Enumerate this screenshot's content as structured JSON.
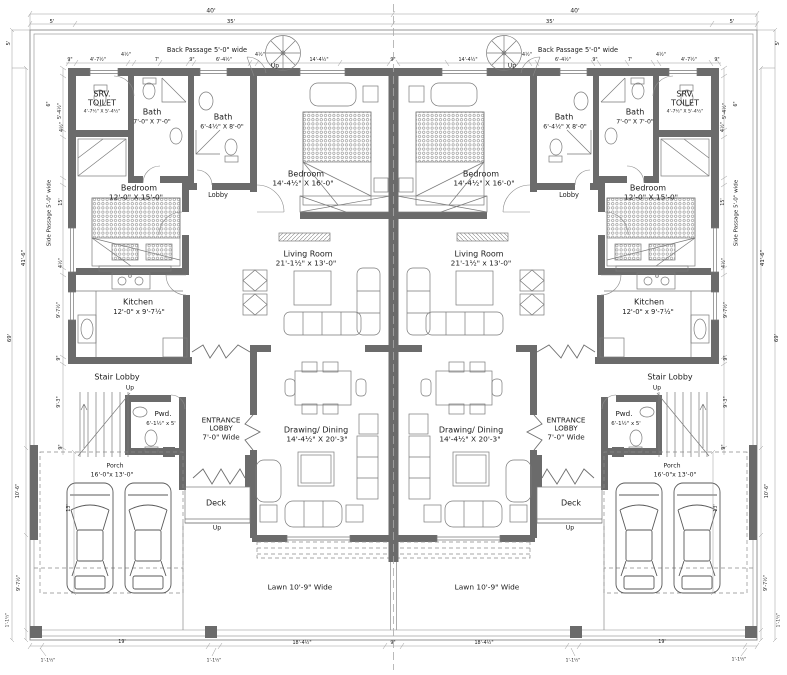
{
  "colors": {
    "wall": "#6b6b6b",
    "line": "#7a7a7a",
    "dim_line": "#9a9a9a",
    "text": "#1b1b1b"
  },
  "site": {
    "back_passage": "Back Passage 5'-0\" wide",
    "side_passage": "Side Passage 5'-0\" wide",
    "lawn": "Lawn 10'-9\" Wide"
  },
  "labels": [
    {
      "id": "room-srv-toilet-left-name",
      "t": "SRV.\nTOILET",
      "x": 102,
      "y": 99,
      "fs": 8
    },
    {
      "id": "room-srv-toilet-left-size",
      "t": "4'-7½\" X 5'-4½\"",
      "x": 102,
      "y": 112,
      "fs": 4.6
    },
    {
      "id": "room-bath1-left-name",
      "t": "Bath",
      "x": 152,
      "y": 112,
      "fs": 8
    },
    {
      "id": "room-bath1-left-size",
      "t": "7'-0\" X 7'-0\"",
      "x": 152,
      "y": 122,
      "fs": 6.2
    },
    {
      "id": "room-bath2-left-name",
      "t": "Bath",
      "x": 223,
      "y": 117,
      "fs": 8
    },
    {
      "id": "room-bath2-left-size",
      "t": "6'-4½\" X 8'-0\"",
      "x": 222,
      "y": 127,
      "fs": 6.2
    },
    {
      "id": "room-bedroom-center-left-name",
      "t": "Bedroom",
      "x": 306,
      "y": 174,
      "fs": 8
    },
    {
      "id": "room-bedroom-center-left-size",
      "t": "14'-4½\" X 16'-0\"",
      "x": 303,
      "y": 184,
      "fs": 7.4
    },
    {
      "id": "room-lobby-left",
      "t": "Lobby",
      "x": 218,
      "y": 196,
      "fs": 6.6
    },
    {
      "id": "room-bedroom-side-left-name",
      "t": "Bedroom",
      "x": 139,
      "y": 188,
      "fs": 8
    },
    {
      "id": "room-bedroom-side-left-size",
      "t": "12'-0\" X 15'-0\"",
      "x": 136,
      "y": 198,
      "fs": 7.4
    },
    {
      "id": "room-living-left-name",
      "t": "Living Room",
      "x": 308,
      "y": 254,
      "fs": 8
    },
    {
      "id": "room-living-left-size",
      "t": "21'-1½\" x 13'-0\"",
      "x": 306,
      "y": 264,
      "fs": 7.4
    },
    {
      "id": "room-kitchen-left-name",
      "t": "Kitchen",
      "x": 138,
      "y": 302,
      "fs": 8
    },
    {
      "id": "room-kitchen-left-size",
      "t": "12'-0\" x 9'-7½\"",
      "x": 139,
      "y": 312,
      "fs": 6.8
    },
    {
      "id": "room-stair-lobby-left",
      "t": "Stair Lobby",
      "x": 117,
      "y": 377,
      "fs": 8
    },
    {
      "id": "label-up-stair-left",
      "t": "Up",
      "x": 130,
      "y": 388,
      "fs": 6
    },
    {
      "id": "room-pwd-left-name",
      "t": "Pwd.",
      "x": 163,
      "y": 414,
      "fs": 7.2
    },
    {
      "id": "room-pwd-left-size",
      "t": "6'-1½\" x 5'",
      "x": 161,
      "y": 424,
      "fs": 5.4
    },
    {
      "id": "room-entrance-lobby-left",
      "t": "ENTRANCE\nLOBBY\n7'-0\" Wide",
      "x": 221,
      "y": 429,
      "fs": 7.2
    },
    {
      "id": "room-drawing-dining-left-name",
      "t": "Drawing/ Dining",
      "x": 316,
      "y": 430,
      "fs": 8
    },
    {
      "id": "room-drawing-dining-left-size",
      "t": "14'-4½\" X 20'-3\"",
      "x": 317,
      "y": 440,
      "fs": 7.4
    },
    {
      "id": "room-deck-left",
      "t": "Deck",
      "x": 216,
      "y": 503,
      "fs": 8
    },
    {
      "id": "label-up-deck-left",
      "t": "Up",
      "x": 217,
      "y": 528,
      "fs": 6.2
    },
    {
      "id": "room-porch-left-name",
      "t": "Porch",
      "x": 115,
      "y": 466,
      "fs": 6.2
    },
    {
      "id": "room-porch-left-size",
      "t": "16'-0\"x 13'-0\"",
      "x": 112,
      "y": 475,
      "fs": 6.2
    },
    {
      "id": "label-lawn-left",
      "t": "Lawn 10'-9\" Wide",
      "x": 300,
      "y": 588,
      "fs": 7.4
    },
    {
      "id": "label-back-passage-left",
      "t": "Back Passage 5'-0\" wide",
      "x": 207,
      "y": 51,
      "fs": 6.6
    },
    {
      "id": "label-side-passage-left",
      "t": "Side Passage 5'-0\" wide",
      "x": 50,
      "y": 213,
      "fs": 5.6,
      "r": 1
    },
    {
      "id": "label-up-spiral-left",
      "t": "Up",
      "x": 275,
      "y": 66,
      "fs": 6
    },
    {
      "id": "room-srv-toilet-right-name",
      "t": "SRV.\nTOILET",
      "x": 685,
      "y": 99,
      "fs": 8
    },
    {
      "id": "room-srv-toilet-right-size",
      "t": "4'-7½\" X 5'-4½\"",
      "x": 685,
      "y": 112,
      "fs": 4.6
    },
    {
      "id": "room-bath1-right-name",
      "t": "Bath",
      "x": 635,
      "y": 112,
      "fs": 8
    },
    {
      "id": "room-bath1-right-size",
      "t": "7'-0\" X 7'-0\"",
      "x": 635,
      "y": 122,
      "fs": 6.2
    },
    {
      "id": "room-bath2-right-name",
      "t": "Bath",
      "x": 564,
      "y": 117,
      "fs": 8
    },
    {
      "id": "room-bath2-right-size",
      "t": "6'-4½\" X 8'-0\"",
      "x": 565,
      "y": 127,
      "fs": 6.2
    },
    {
      "id": "room-bedroom-center-right-name",
      "t": "Bedroom",
      "x": 481,
      "y": 174,
      "fs": 8
    },
    {
      "id": "room-bedroom-center-right-size",
      "t": "14'-4½\" X 16'-0\"",
      "x": 484,
      "y": 184,
      "fs": 7.4
    },
    {
      "id": "room-lobby-right",
      "t": "Lobby",
      "x": 569,
      "y": 196,
      "fs": 6.6
    },
    {
      "id": "room-bedroom-side-right-name",
      "t": "Bedroom",
      "x": 648,
      "y": 188,
      "fs": 8
    },
    {
      "id": "room-bedroom-side-right-size",
      "t": "12'-0\" X 15'-0\"",
      "x": 651,
      "y": 198,
      "fs": 7.4
    },
    {
      "id": "room-living-right-name",
      "t": "Living Room",
      "x": 479,
      "y": 254,
      "fs": 8
    },
    {
      "id": "room-living-right-size",
      "t": "21'-1½\" x 13'-0\"",
      "x": 481,
      "y": 264,
      "fs": 7.4
    },
    {
      "id": "room-kitchen-right-name",
      "t": "Kitchen",
      "x": 649,
      "y": 302,
      "fs": 8
    },
    {
      "id": "room-kitchen-right-size",
      "t": "12'-0\" x 9'-7½\"",
      "x": 648,
      "y": 312,
      "fs": 6.8
    },
    {
      "id": "room-stair-lobby-right",
      "t": "Stair Lobby",
      "x": 670,
      "y": 377,
      "fs": 8
    },
    {
      "id": "label-up-stair-right",
      "t": "Up",
      "x": 657,
      "y": 388,
      "fs": 6
    },
    {
      "id": "room-pwd-right-name",
      "t": "Pwd.",
      "x": 624,
      "y": 414,
      "fs": 7.2
    },
    {
      "id": "room-pwd-right-size",
      "t": "6'-1½\" x 5'",
      "x": 626,
      "y": 424,
      "fs": 5.4
    },
    {
      "id": "room-entrance-lobby-right",
      "t": "ENTRANCE\nLOBBY\n7'-0\" Wide",
      "x": 566,
      "y": 429,
      "fs": 7.2
    },
    {
      "id": "room-drawing-dining-right-name",
      "t": "Drawing/ Dining",
      "x": 471,
      "y": 430,
      "fs": 8
    },
    {
      "id": "room-drawing-dining-right-size",
      "t": "14'-4½\" X 20'-3\"",
      "x": 470,
      "y": 440,
      "fs": 7.4
    },
    {
      "id": "room-deck-right",
      "t": "Deck",
      "x": 571,
      "y": 503,
      "fs": 8
    },
    {
      "id": "label-up-deck-right",
      "t": "Up",
      "x": 570,
      "y": 528,
      "fs": 6.2
    },
    {
      "id": "room-porch-right-name",
      "t": "Porch",
      "x": 672,
      "y": 466,
      "fs": 6.2
    },
    {
      "id": "room-porch-right-size",
      "t": "16'-0\"x 13'-0\"",
      "x": 675,
      "y": 475,
      "fs": 6.2
    },
    {
      "id": "label-lawn-right",
      "t": "Lawn 10'-9\" Wide",
      "x": 487,
      "y": 588,
      "fs": 7.4
    },
    {
      "id": "label-back-passage-right",
      "t": "Back Passage 5'-0\" wide",
      "x": 578,
      "y": 51,
      "fs": 6.6
    },
    {
      "id": "label-side-passage-right",
      "t": "Side Passage 5'-0\" wide",
      "x": 737,
      "y": 213,
      "fs": 5.6,
      "r": 1
    },
    {
      "id": "label-up-spiral-right",
      "t": "Up",
      "x": 512,
      "y": 66,
      "fs": 6
    },
    {
      "id": "dim-40ft-left",
      "t": "40'",
      "x": 211,
      "y": 11,
      "fs": 6
    },
    {
      "id": "dim-40ft-right",
      "t": "40'",
      "x": 575,
      "y": 11,
      "fs": 6
    },
    {
      "id": "dim-5ft-top-left",
      "t": "5'",
      "x": 52,
      "y": 22,
      "fs": 5.4
    },
    {
      "id": "dim-35ft-top-left",
      "t": "35'",
      "x": 231,
      "y": 22,
      "fs": 5.4
    },
    {
      "id": "dim-35ft-top-right",
      "t": "35'",
      "x": 550,
      "y": 22,
      "fs": 5.4
    },
    {
      "id": "dim-5ft-top-right",
      "t": "5'",
      "x": 732,
      "y": 22,
      "fs": 5.4
    },
    {
      "id": "dim-9in-top-a-left",
      "t": "9\"",
      "x": 70,
      "y": 61,
      "fs": 4.8
    },
    {
      "id": "dim-4-7-top-left",
      "t": "4'-7½\"",
      "x": 98,
      "y": 61,
      "fs": 4.8
    },
    {
      "id": "dim-4h-top-a-left",
      "t": "4½\"",
      "x": 126,
      "y": 56,
      "fs": 4.8
    },
    {
      "id": "dim-7ft-top-left",
      "t": "7'",
      "x": 157,
      "y": 61,
      "fs": 4.8
    },
    {
      "id": "dim-9in-top-b-left",
      "t": "9\"",
      "x": 192,
      "y": 61,
      "fs": 4.8
    },
    {
      "id": "dim-6-4-top-left",
      "t": "6'-4½\"",
      "x": 224,
      "y": 61,
      "fs": 4.8
    },
    {
      "id": "dim-4h-top-b-left",
      "t": "4½\"",
      "x": 260,
      "y": 56,
      "fs": 4.8
    },
    {
      "id": "dim-14-4-top-left",
      "t": "14'-4½\"",
      "x": 319,
      "y": 61,
      "fs": 4.8
    },
    {
      "id": "dim-9in-top-center",
      "t": "9\"",
      "x": 393,
      "y": 61,
      "fs": 4.8
    },
    {
      "id": "dim-14-4-top-right",
      "t": "14'-4½\"",
      "x": 468,
      "y": 61,
      "fs": 4.8
    },
    {
      "id": "dim-4h-top-b-right",
      "t": "4½\"",
      "x": 527,
      "y": 56,
      "fs": 4.8
    },
    {
      "id": "dim-6-4-top-right",
      "t": "6'-4½\"",
      "x": 563,
      "y": 61,
      "fs": 4.8
    },
    {
      "id": "dim-9in-top-b-right",
      "t": "9\"",
      "x": 595,
      "y": 61,
      "fs": 4.8
    },
    {
      "id": "dim-7ft-top-right",
      "t": "7'",
      "x": 630,
      "y": 61,
      "fs": 4.8
    },
    {
      "id": "dim-4h-top-a-right",
      "t": "4½\"",
      "x": 661,
      "y": 56,
      "fs": 4.8
    },
    {
      "id": "dim-4-7-top-right",
      "t": "4'-7½\"",
      "x": 689,
      "y": 61,
      "fs": 4.8
    },
    {
      "id": "dim-9in-top-a-right",
      "t": "9\"",
      "x": 717,
      "y": 61,
      "fs": 4.8
    },
    {
      "id": "dim-5ft-side-left",
      "t": "5'",
      "x": 9,
      "y": 43,
      "fs": 5.4,
      "r": 1
    },
    {
      "id": "dim-6in-left",
      "t": "6\"",
      "x": 50,
      "y": 104,
      "fs": 4.8,
      "r": 1
    },
    {
      "id": "dim-5-4-left",
      "t": "5'-4½\"",
      "x": 61,
      "y": 111,
      "fs": 4.8,
      "r": 1
    },
    {
      "id": "dim-4h-left-a",
      "t": "4½\"",
      "x": 63,
      "y": 127,
      "fs": 4.8,
      "r": 1
    },
    {
      "id": "dim-15ft-left",
      "t": "15'",
      "x": 62,
      "y": 202,
      "fs": 4.8,
      "r": 1
    },
    {
      "id": "dim-4h-left-b",
      "t": "4½\"",
      "x": 62,
      "y": 263,
      "fs": 4.8,
      "r": 1
    },
    {
      "id": "dim-9-7-left",
      "t": "9'-7½\"",
      "x": 60,
      "y": 310,
      "fs": 4.8,
      "r": 1
    },
    {
      "id": "dim-9in-left-a",
      "t": "9\"",
      "x": 60,
      "y": 358,
      "fs": 4.8,
      "r": 1
    },
    {
      "id": "dim-9-3-left",
      "t": "9'-3\"",
      "x": 60,
      "y": 402,
      "fs": 4.8,
      "r": 1
    },
    {
      "id": "dim-9in-left-b",
      "t": "9\"",
      "x": 62,
      "y": 447,
      "fs": 4.8,
      "r": 1
    },
    {
      "id": "dim-41-6-left",
      "t": "41'-6\"",
      "x": 24,
      "y": 258,
      "fs": 5.4,
      "r": 1
    },
    {
      "id": "dim-69ft-left",
      "t": "69'",
      "x": 10,
      "y": 338,
      "fs": 5.4,
      "r": 1
    },
    {
      "id": "dim-10-6-left",
      "t": "10'-6\"",
      "x": 19,
      "y": 491,
      "fs": 4.8,
      "r": 1
    },
    {
      "id": "dim-13ft-left",
      "t": "13'",
      "x": 70,
      "y": 508,
      "fs": 4.8,
      "r": 1
    },
    {
      "id": "dim-9-7-left-b",
      "t": "9'-7½\"",
      "x": 20,
      "y": 583,
      "fs": 4.8,
      "r": 1
    },
    {
      "id": "dim-1-1-left-edge",
      "t": "1'-1½\"",
      "x": 8,
      "y": 620,
      "fs": 4.4,
      "r": 1
    },
    {
      "id": "dim-5ft-side-right",
      "t": "5'",
      "x": 778,
      "y": 43,
      "fs": 5.4,
      "r": 1
    },
    {
      "id": "dim-6in-right",
      "t": "6\"",
      "x": 737,
      "y": 104,
      "fs": 4.8,
      "r": 1
    },
    {
      "id": "dim-5-4-right",
      "t": "5'-4½\"",
      "x": 726,
      "y": 111,
      "fs": 4.8,
      "r": 1
    },
    {
      "id": "dim-4h-right-a",
      "t": "4½\"",
      "x": 724,
      "y": 127,
      "fs": 4.8,
      "r": 1
    },
    {
      "id": "dim-15ft-right",
      "t": "15'",
      "x": 724,
      "y": 202,
      "fs": 4.8,
      "r": 1
    },
    {
      "id": "dim-4h-right-b",
      "t": "4½\"",
      "x": 725,
      "y": 263,
      "fs": 4.8,
      "r": 1
    },
    {
      "id": "dim-9-7-right",
      "t": "9'-7½\"",
      "x": 727,
      "y": 310,
      "fs": 4.8,
      "r": 1
    },
    {
      "id": "dim-9in-right-a",
      "t": "9\"",
      "x": 727,
      "y": 358,
      "fs": 4.8,
      "r": 1
    },
    {
      "id": "dim-9-3-right",
      "t": "9'-3\"",
      "x": 727,
      "y": 402,
      "fs": 4.8,
      "r": 1
    },
    {
      "id": "dim-9in-right-b",
      "t": "9\"",
      "x": 725,
      "y": 447,
      "fs": 4.8,
      "r": 1
    },
    {
      "id": "dim-41-6-right",
      "t": "41'-6\"",
      "x": 763,
      "y": 258,
      "fs": 5.4,
      "r": 1
    },
    {
      "id": "dim-69ft-right",
      "t": "69'",
      "x": 777,
      "y": 338,
      "fs": 5.4,
      "r": 1
    },
    {
      "id": "dim-10-6-right",
      "t": "10'-6\"",
      "x": 768,
      "y": 491,
      "fs": 4.8,
      "r": 1
    },
    {
      "id": "dim-13ft-right",
      "t": "13'",
      "x": 717,
      "y": 508,
      "fs": 4.8,
      "r": 1
    },
    {
      "id": "dim-9-7-right-b",
      "t": "9'-7½\"",
      "x": 767,
      "y": 583,
      "fs": 4.8,
      "r": 1
    },
    {
      "id": "dim-1-1-right-edge",
      "t": "1'-1½\"",
      "x": 779,
      "y": 620,
      "fs": 4.4,
      "r": 1
    },
    {
      "id": "dim-1-1-bottom-a",
      "t": "1'-1½\"",
      "x": 48,
      "y": 661,
      "fs": 4.4
    },
    {
      "id": "dim-19ft-bottom-left",
      "t": "19'",
      "x": 122,
      "y": 643,
      "fs": 4.8
    },
    {
      "id": "dim-1-1-bottom-b",
      "t": "1'-1½\"",
      "x": 214,
      "y": 661,
      "fs": 4.4
    },
    {
      "id": "dim-18-4-bottom-left",
      "t": "18'-4½\"",
      "x": 302,
      "y": 644,
      "fs": 4.8
    },
    {
      "id": "dim-9in-bottom-center",
      "t": "9\"",
      "x": 393,
      "y": 644,
      "fs": 4.8
    },
    {
      "id": "dim-18-4-bottom-right",
      "t": "18'-4½\"",
      "x": 484,
      "y": 644,
      "fs": 4.8
    },
    {
      "id": "dim-1-1-bottom-c",
      "t": "1'-1½\"",
      "x": 573,
      "y": 661,
      "fs": 4.4
    },
    {
      "id": "dim-19ft-bottom-right",
      "t": "19'",
      "x": 662,
      "y": 643,
      "fs": 4.8
    },
    {
      "id": "dim-1-1-bottom-d",
      "t": "1'-1½\"",
      "x": 739,
      "y": 660,
      "fs": 4.4
    }
  ]
}
